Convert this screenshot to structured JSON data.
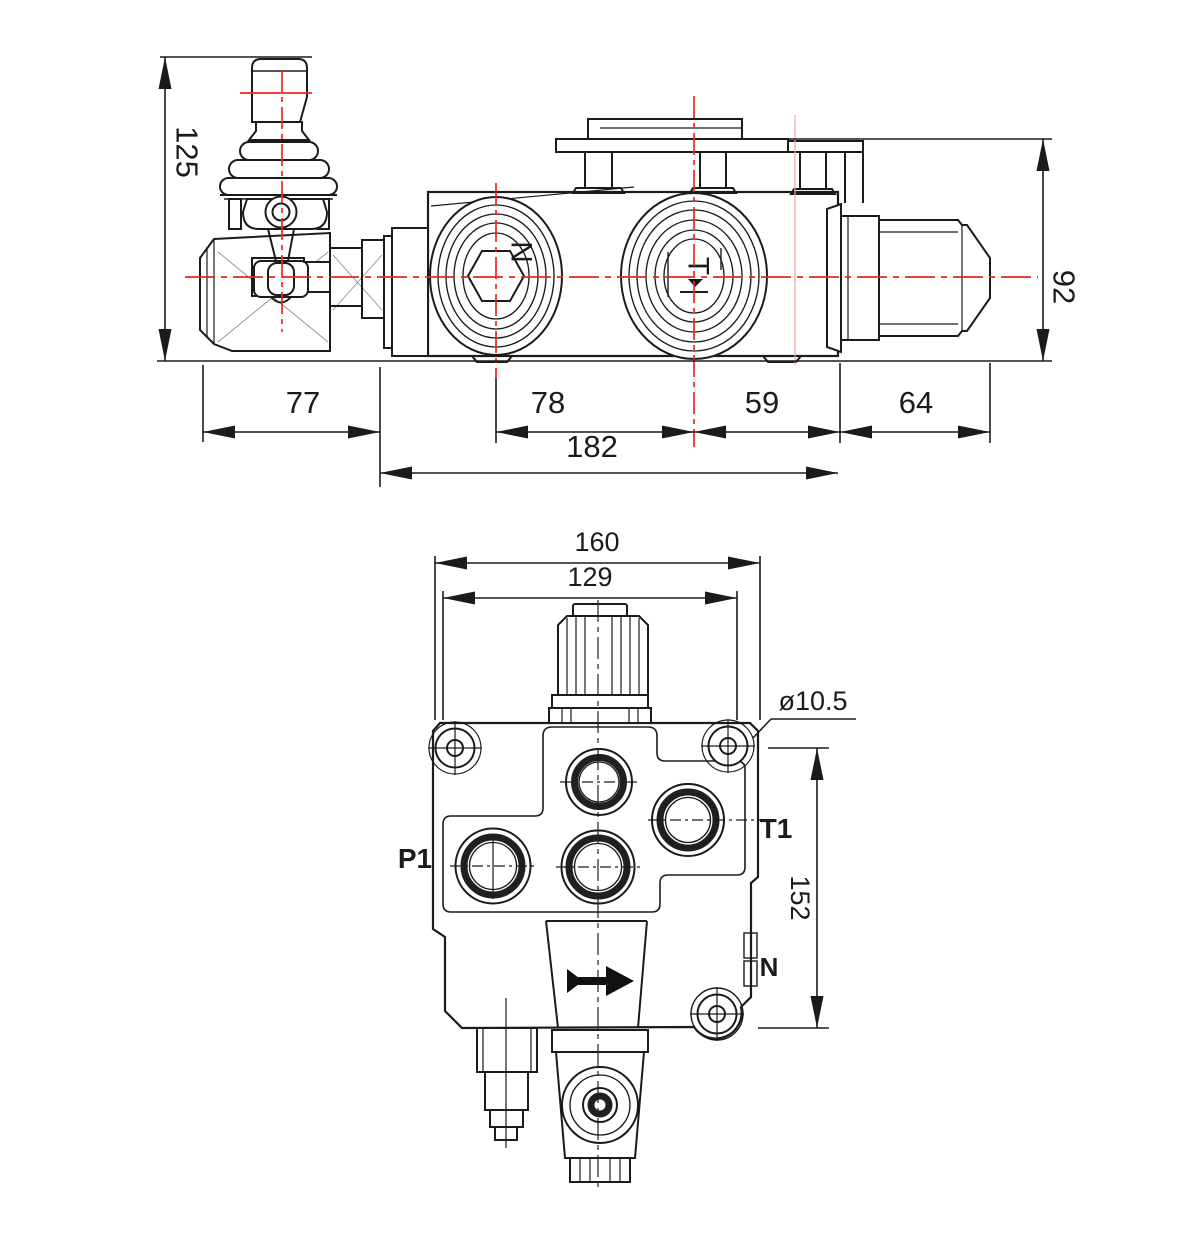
{
  "drawing": {
    "kind": "hydraulic monoblock valve dimensional drawing",
    "views": [
      "side elevation with control lever",
      "end face with ports"
    ]
  },
  "colors": {
    "line": "#1b1b1b",
    "centerline_red": "#e8281e",
    "centerline_faint": "#f3a49e",
    "background": "#ffffff"
  },
  "side_view": {
    "dim_height_overall": "125",
    "dim_height_body": "92",
    "dim_left_section": "77",
    "dim_port_spacing": "78",
    "dim_port_to_face": "59",
    "dim_fitting_length": "64",
    "dim_body_length": "182",
    "port_left_label": "N",
    "port_right_label": "T"
  },
  "end_view": {
    "dim_width_overall": "160",
    "dim_mount_width": "129",
    "dim_hole_diameter": "ø10.5",
    "dim_height": "152",
    "label_p1": "P1",
    "label_t1": "T1",
    "label_n": "N"
  }
}
